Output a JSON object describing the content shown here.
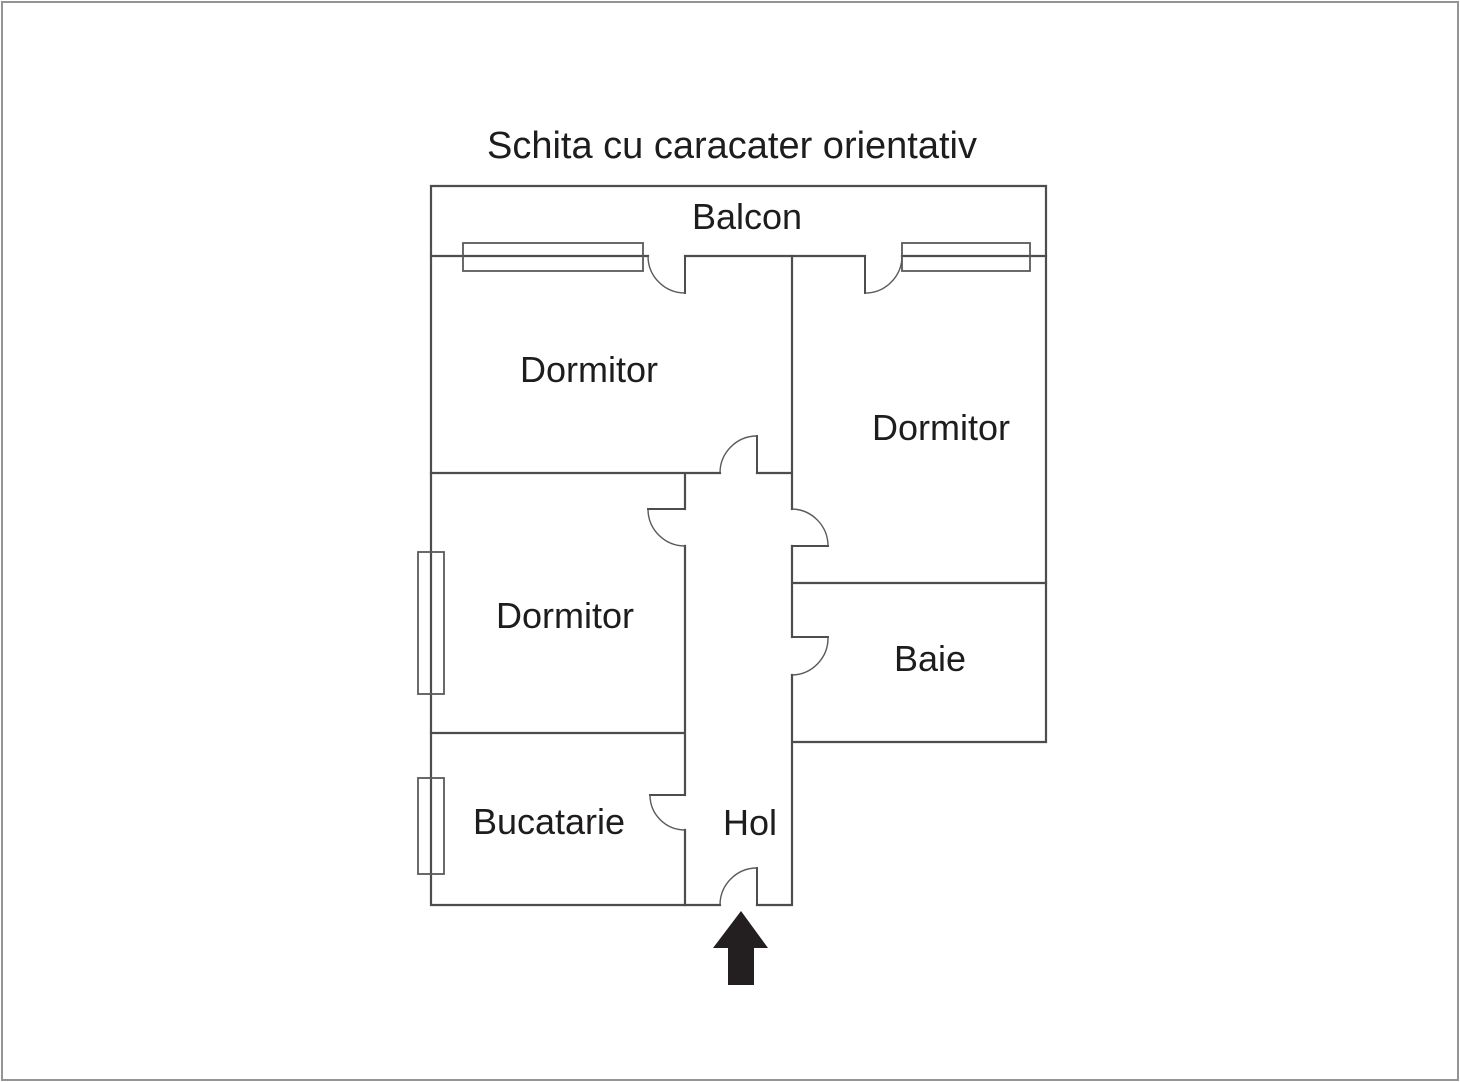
{
  "title": "Schita cu caracater orientativ",
  "rooms": {
    "balcon": "Balcon",
    "dormitor_top_left": "Dormitor",
    "dormitor_right": "Dormitor",
    "dormitor_middle": "Dormitor",
    "baie": "Baie",
    "bucatarie": "Bucatarie",
    "hol": "Hol"
  },
  "entrance": {
    "arrow_direction": "up"
  },
  "colors": {
    "wall": "#4d4d4f",
    "thin_line": "#5a5a5c",
    "text": "#1e1c1d",
    "arrow": "#231f20",
    "border": "#949494",
    "background": "#ffffff"
  }
}
